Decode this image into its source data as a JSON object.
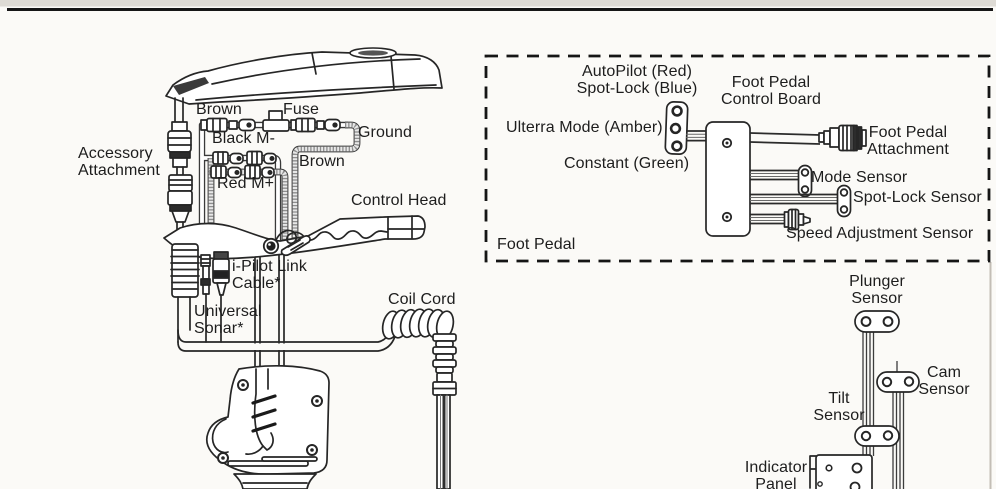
{
  "meta": {
    "description": "Trolling motor exploded wiring diagram with foot pedal inset",
    "colors": {
      "ink": "#262626",
      "background": "#fbfaf7",
      "hatch_gray": "#8d8d8d",
      "page_edge": "#c3beb6"
    }
  },
  "motor": {
    "accessory_attachment": "Accessory\nAttachment",
    "brown_top": "Brown",
    "fuse": "Fuse",
    "black_m": "Black M-",
    "ground": "Ground",
    "brown_right": "Brown",
    "red_m": "Red M+",
    "control_head": "Control Head",
    "ipilot_link_cable": "i-Pilot Link\nCable*",
    "universal_sonar": "Universal\nSonar*",
    "coil_cord": "Coil Cord"
  },
  "foot_pedal_inset": {
    "autopilot_spotlock": "AutoPilot (Red)\nSpot-Lock (Blue)",
    "ulterra_mode": "Ulterra Mode (Amber)",
    "constant": "Constant (Green)",
    "control_board": "Foot Pedal\nControl Board",
    "foot_pedal_attachment": "Foot Pedal\nAttachment",
    "mode_sensor": "Mode Sensor",
    "spotlock_sensor": "Spot-Lock Sensor",
    "speed_adjustment_sensor": "Speed Adjustment Sensor",
    "foot_pedal": "Foot Pedal"
  },
  "sensors": {
    "plunger_sensor": "Plunger\nSensor",
    "cam_sensor": "Cam\nSensor",
    "tilt_sensor": "Tilt\nSensor",
    "indicator_panel": "Indicator\nPanel"
  }
}
